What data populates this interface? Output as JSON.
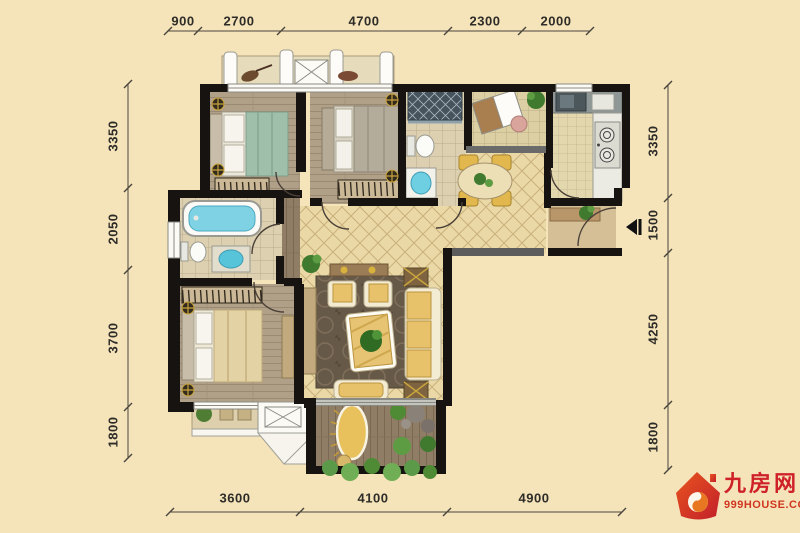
{
  "palette": {
    "background": "#f5e4ba",
    "wall": "#171310",
    "dimension_text": "#2e2c28",
    "logo_red": "#cf2128",
    "logo_orange": "#d0361f",
    "water_blue": "#6fcfe2",
    "sofa_yellow": "#e7c26a"
  },
  "dimensions": {
    "top": [
      "900",
      "2700",
      "4700",
      "2300",
      "2000"
    ],
    "left": [
      "3350",
      "2050",
      "3700",
      "1800"
    ],
    "right": [
      "3350",
      "1500",
      "4250",
      "1800"
    ],
    "bottom": [
      "3600",
      "4100",
      "4900"
    ]
  },
  "logo": {
    "brand": "九房网",
    "domain": "999HOUSE.COM"
  },
  "icons": {
    "entry_marker": "entry-arrow-icon",
    "lamp": "ceiling-lamp-icon",
    "plant": "plant-icon",
    "logo_house": "house-logo-icon"
  }
}
